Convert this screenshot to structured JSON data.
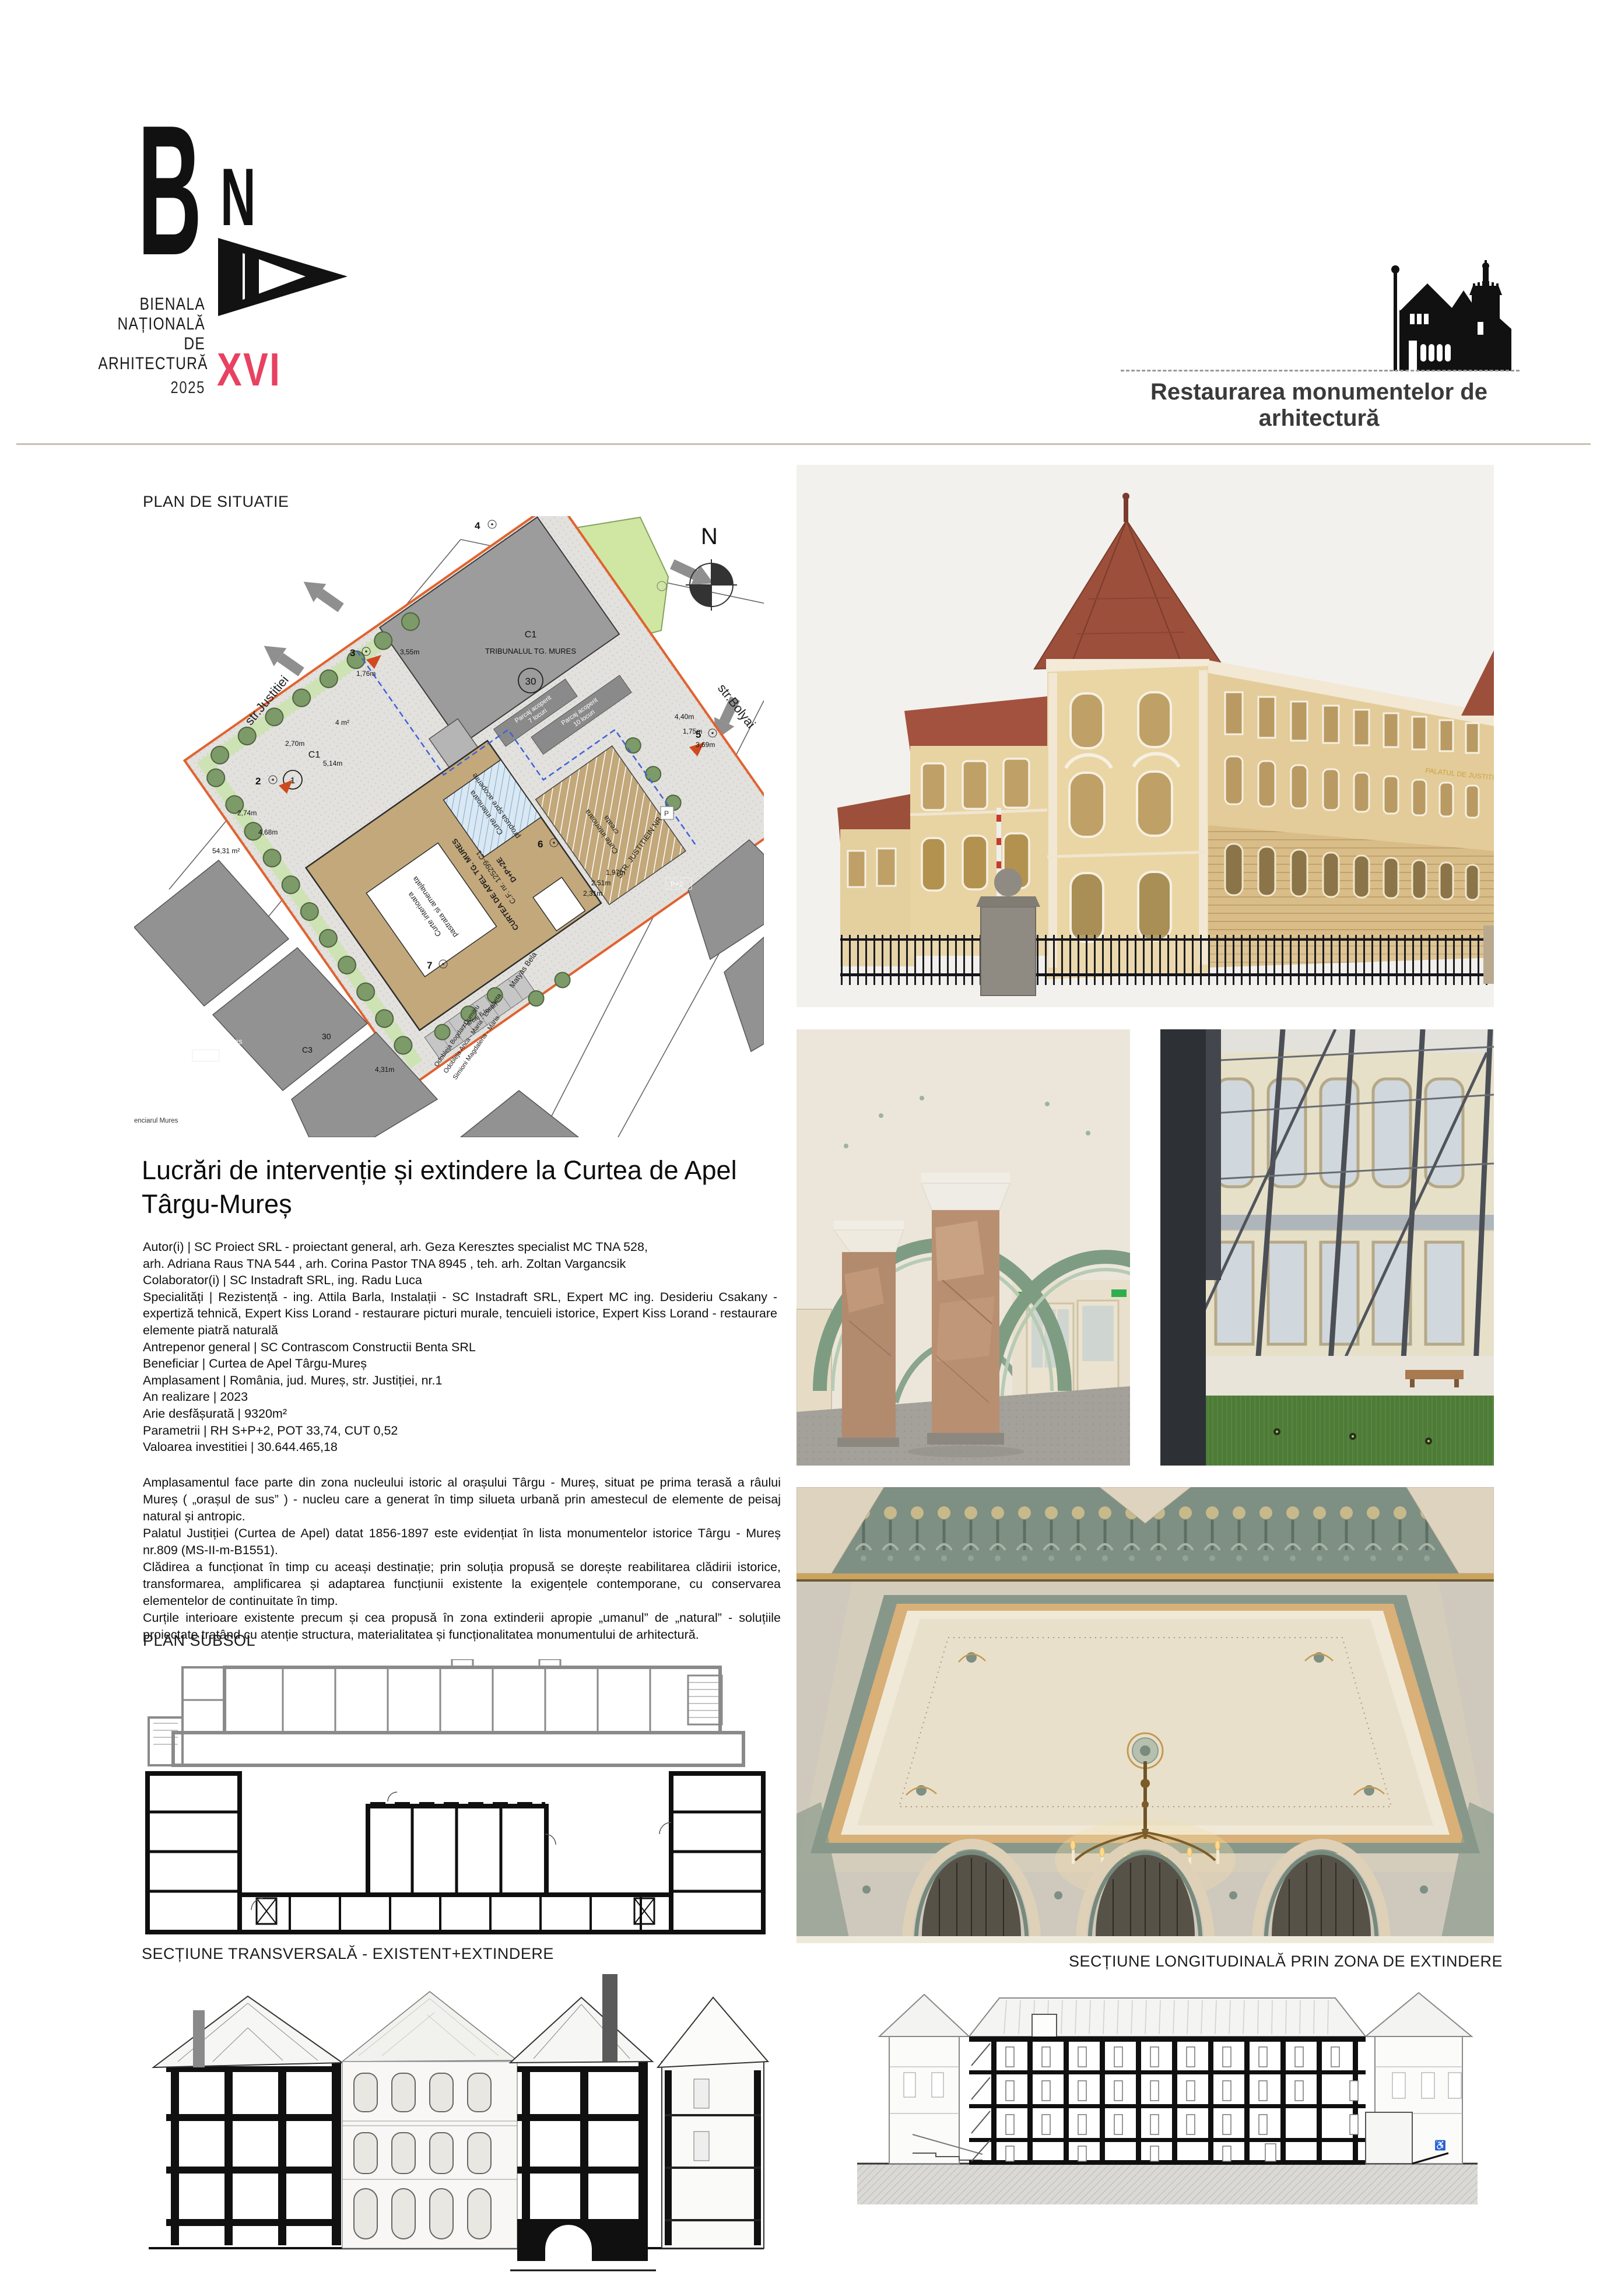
{
  "page": {
    "background": "#ffffff",
    "divider_color": "#c9c0b2",
    "accent": "#e84162"
  },
  "header": {
    "logo": {
      "b": "B",
      "n": "N",
      "a": "A",
      "line1": "BIENALA",
      "line2": "NAȚIONALĂ",
      "line3": "DE",
      "line4": "ARHITECTURĂ",
      "year": "2025",
      "edition": "XVI",
      "edition_color": "#e84162"
    },
    "category_label": "Restaurarea monumentelor de arhitectură"
  },
  "left_column": {
    "site_plan_label": "PLAN DE SITUATIE",
    "project_title": "Lucrări de intervenție și extindere la Curtea de Apel Târgu-Mureș",
    "credits": "Autor(i) | SC Proiect SRL - proiectant general, arh. Geza Keresztes specialist MC TNA 528,\narh. Adriana Raus TNA 544 , arh. Corina Pastor TNA 8945 , teh. arh. Zoltan Vargancsik\nColaborator(i) | SC Instadraft SRL, ing. Radu Luca\nSpecialități | Rezistență - ing. Attila Barla, Instalații - SC Instadraft SRL, Expert MC ing. Desideriu Csakany - expertiză tehnică, Expert Kiss Lorand - restaurare picturi murale, tencuieli istorice, Expert Kiss Lorand - restaurare elemente piatră naturală\nAntrepenor general | SC Contrascom Constructii Benta SRL\nBeneficiar | Curtea de Apel Târgu-Mureș\nAmplasament | România, jud. Mureș, str. Justiției, nr.1\nAn realizare | 2023\nArie desfășurată | 9320m²\nParametrii | RH S+P+2, POT 33,74, CUT 0,52\nValoarea investitiei | 30.644.465,18",
    "description": "Amplasamentul face parte din zona nucleului istoric al orașului Târgu - Mureș, situat pe prima terasă a râului Mureș ( „orașul de sus” ) - nucleu care a generat în timp silueta urbană prin amestecul de elemente de peisaj natural și antropic.\nPalatul Justiției (Curtea de Apel) datat 1856-1897 este evidențiat în lista monumentelor istorice Târgu - Mureș nr.809 (MS-II-m-B1551).\nClădirea a funcționat în timp cu aceași destinație; prin soluția propusă se dorește reabilitarea clădirii istorice, transformarea, amplificarea și adaptarea funcțiunii existente la exigențele contemporane, cu conservarea elementelor de continuitate în timp.\nCurțile interioare existente precum și cea propusă în zona extinderii apropie „umanul” de „natural” - soluțiile proiectate tratând cu atenție structura, materialitatea și funcționalitatea monumentului de arhitectură.",
    "plan_subsol_label": "PLAN SUBSOL",
    "section_transversal_label": "SECȚIUNE TRANSVERSALĂ - EXISTENT+EXTINDERE"
  },
  "right_column": {
    "section_longitudinal_label": "SECȚIUNE LONGITUDINALĂ PRIN ZONA DE EXTINDERE",
    "facade_sign": "PALATUL DE JUSTITIE"
  },
  "site_plan": {
    "north": "N",
    "street_left": "str.Justitiei",
    "street_right": "str.Bolyai",
    "tribunal_c1": "C1",
    "tribunal_name": "TRIBUNALUL TG. MURES",
    "tribunal_no": "30",
    "main_c1": "C1",
    "main_no": "1",
    "court_kept_1": "Curte interioara",
    "court_kept_2": "pastrata si amenajata",
    "court_cover_1": "Curte interioara",
    "court_cover_2": "propusa spre acoperire",
    "court_new_1": "Curte interioara",
    "court_new_2": "creata",
    "apel_1": "CURTEA DE APEL TG. MURES",
    "apel_2": "C.F. nr. 125299-C1",
    "apel_3": "D+P+2E",
    "parking7_1": "Parcaj acoperit",
    "parking7_2": "7 locuri",
    "parking10_1": "Parcaj acoperit",
    "parking10_2": "10 locuri",
    "parking6": "Parcaj 6 locuri",
    "str32": "STR. JUSTITIEIN NR 32",
    "matyas": "Matyas Bela",
    "penitenciar": "Penitenciarul Mures",
    "penitenciar2": "enciarul Mures",
    "p1": "P+1",
    "p2": "P+2",
    "p": "P",
    "c3": "C3",
    "no30": "30",
    "owner_1": "Odobleja Bogdan Dumitru",
    "owner_2": "Odobleja Anca - Maria - Elisabeta",
    "owner_3": "Simioni Magdalena - Maria",
    "pt2": "2",
    "pt3": "3",
    "pt4": "4",
    "pt5": "5",
    "pt6": "6",
    "pt7": "7",
    "meas": [
      "3,55m",
      "1,76m",
      "2,70m",
      "5,14m",
      "2,74m",
      "4,68m",
      "54,31 m²",
      "4 m²",
      "4,40m",
      "1,75m",
      "3,69m",
      "1,97m",
      "2,51m",
      "2,31m",
      "4,31m"
    ]
  },
  "icons": {
    "wheelchair": "♿"
  }
}
